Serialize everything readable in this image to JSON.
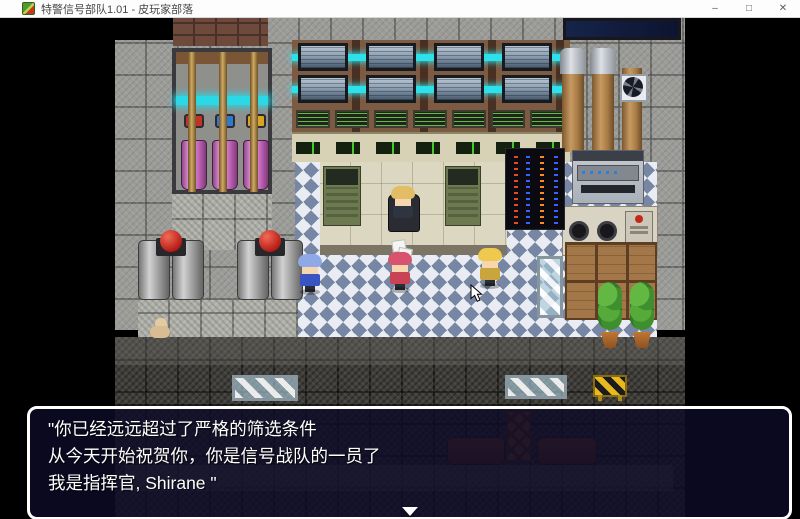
{
  "window": {
    "title": "特警信号部队1.01 - 皮玩家部落",
    "controls": {
      "minimize": "–",
      "maximize": "□",
      "close": "✕"
    }
  },
  "dialog": {
    "lines": [
      "\"你已经远远超过了严格的筛选条件",
      "从今天开始祝贺你，你是信号战队的一员了",
      "我是指挥官, Shirane \""
    ]
  },
  "scene": {
    "entities": [
      "server-monitor-wall",
      "terminal-screen-row",
      "console-row",
      "pink-coolant-tanks",
      "red-button-boilers",
      "led-server-racks",
      "ventilation-ducts",
      "fan-vent",
      "copier-machine",
      "stove-counter",
      "wooden-crates",
      "potted-plants",
      "glass-display-tables",
      "commander-at-desk",
      "npc-blue-hair",
      "npc-pink-hair",
      "npc-blonde",
      "small-dog",
      "checkered-floor",
      "barricade",
      "mouse-cursor"
    ],
    "colors": {
      "wall_gray": "#9b9b98",
      "floor_checker_blue": "#7787a3",
      "floor_checker_white": "#e9edf3",
      "accent_cyan_glow": "#2ee0ea",
      "tank_pink": "#efa3e2",
      "button_red": "#b51d16",
      "platform_beige": "#dcd7c0",
      "dialog_fill": "#0d0b26",
      "dialog_border": "#ffffff"
    }
  }
}
